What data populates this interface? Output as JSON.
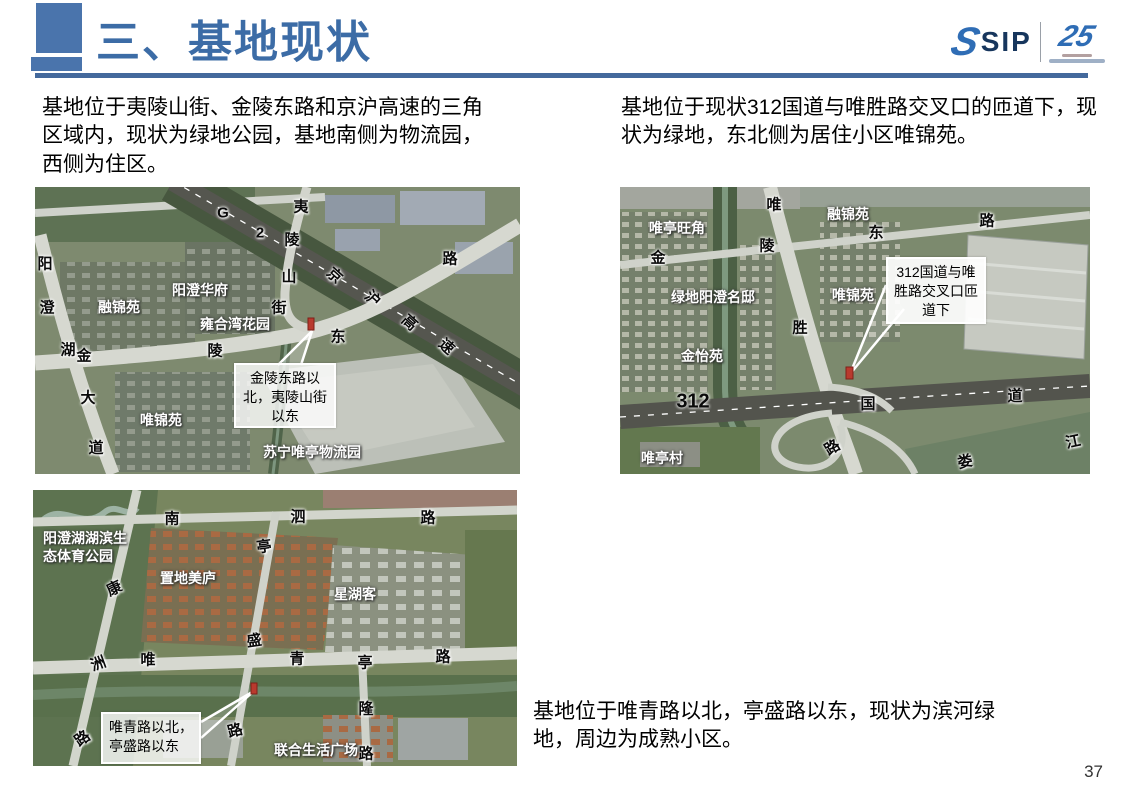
{
  "slide": {
    "title": "三、基地现状",
    "page_number": "37",
    "accent_color": "#4a74ac"
  },
  "logo": {
    "sip": "SIP",
    "anniversary": "25"
  },
  "intro": {
    "left": "基地位于夷陵山街、金陵东路和京沪高速的三角区域内，现状为绿地公园，基地南侧为物流园，西侧为住区。",
    "right": "基地位于现状312国道与唯胜路交叉口的匝道下，现状为绿地，东北侧为居住小区唯锦苑。",
    "bottom": "基地位于唯青路以北，亭盛路以东，现状为滨河绿地，周边为成熟小区。"
  },
  "map1": {
    "callout": "金陵东路以北，夷陵山街以东",
    "roads": {
      "g": "G",
      "two": "2",
      "yi": "夷",
      "ling1": "陵",
      "shan": "山",
      "jie": "街",
      "lu1": "路",
      "jing": "京",
      "hu": "沪",
      "gao": "高",
      "su": "速",
      "yang": "阳",
      "cheng": "澄",
      "hu2": "湖",
      "jin": "金",
      "ling2": "陵",
      "dong": "东",
      "da": "大",
      "dao": "道"
    },
    "places": {
      "rongjin": "融锦苑",
      "huafu": "阳澄华府",
      "yonghe": "雍合湾花园",
      "weijin": "唯锦苑",
      "suning": "苏宁唯亭物流园"
    }
  },
  "map2": {
    "callout": "唯青路以北，亭盛路以东",
    "roads": {
      "nan": "南",
      "si": "泗",
      "lu1": "路",
      "kang": "康",
      "zhou": "洲",
      "lu2": "路",
      "ting1": "亭",
      "sheng": "盛",
      "lu3": "路",
      "wei": "唯",
      "qing": "青",
      "lu4": "路",
      "ting2": "亭",
      "long": "隆",
      "lu5": "路"
    },
    "places": {
      "park": "阳澄湖湖滨生态体育公园",
      "zhidi": "置地美庐",
      "xinghu": "星湖客",
      "lianhe": "联合生活广场"
    }
  },
  "map3": {
    "callout": "312国道与唯胜路交叉口匝道下",
    "roads": {
      "wei": "唯",
      "jin": "金",
      "ling": "陵",
      "dong": "东",
      "lu1": "路",
      "sheng": "胜",
      "g312": "312",
      "guo": "国",
      "dao": "道",
      "lu2": "路",
      "lou": "娄",
      "jiang": "江"
    },
    "places": {
      "rongjin": "融锦苑",
      "wangjiao": "唯亭旺角",
      "lvdi": "绿地阳澄名邸",
      "weijin": "唯锦苑",
      "jinyi": "金怡苑",
      "weitingcun": "唯亭村"
    }
  }
}
